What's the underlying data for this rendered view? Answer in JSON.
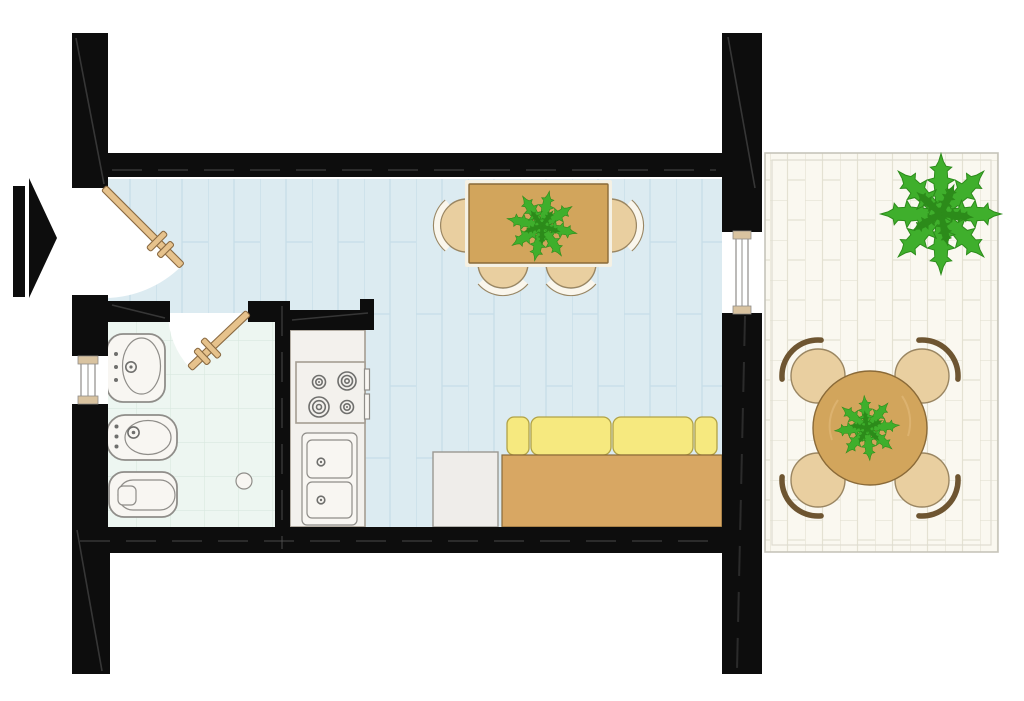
{
  "document": {
    "kind": "floor-plan"
  },
  "colors": {
    "wall": "#0d0d0d",
    "hatch": "#5a5a5a",
    "paper": "#ffffff",
    "livingFloor": "#dcebf1",
    "livingLine": "#c6dde8",
    "bathFloor": "#edf6f1",
    "bathLine": "#d8e8df",
    "terraceFloor": "#faf8f0",
    "terraceLine": "#e4e1d2",
    "terraceBorder": "#c6c4ba",
    "terraceBorderInner": "#dedcd0",
    "wood": "#d2a55c",
    "woodEdge": "#8a6a38",
    "woodLight": "#e0b877",
    "tableFrame": "#f5f1e4",
    "door": "#e6c28c",
    "doorEdge": "#8a6a42",
    "chairSeat": "#e9cfa0",
    "chairSeatEdge": "#9a8662",
    "chairBand": "#faf6ec",
    "chairBackDark": "#6e5531",
    "sofaBase": "#d8a763",
    "sofaCushion": "#f6e97f",
    "sofaCushionEdge": "#b1a246",
    "sideTable": "#efedea",
    "sideTableEdge": "#9a9892",
    "fixture": "#f8f6f2",
    "fixtureEdge": "#8f8d89",
    "counter": "#f3f1ed",
    "counterEdge": "#a59d92",
    "burnerEdge": "#6f6f6d",
    "windowCap": "#d9c3a0",
    "plant": "#3faf2c",
    "plantDark": "#2c8b1a"
  },
  "plan": {
    "rooms": [
      {
        "name": "living-room",
        "floor": "light-blue-planks",
        "furniture": [
          "dining-table",
          "dining-chairs",
          "plant",
          "sofa",
          "side-table"
        ]
      },
      {
        "name": "bathroom",
        "floor": "mint-tile-grid",
        "fixtures": [
          "sink",
          "bidet",
          "toilet",
          "floor-drain"
        ]
      },
      {
        "name": "kitchen",
        "fixtures": [
          "stove-4-burners",
          "double-sink-cabinet"
        ]
      },
      {
        "name": "terrace",
        "floor": "cream-brick-tiles",
        "furniture": [
          "round-table",
          "terrace-chairs",
          "plant"
        ]
      }
    ],
    "symbols": [
      "entrance-arrow",
      "entrance-door-swing",
      "bathroom-door-swing",
      "window-left",
      "window-right"
    ],
    "counts": {
      "dining_chairs": 4,
      "terrace_chairs": 4,
      "stove_burners": 4,
      "sofa_cushions": 4,
      "plants": 3,
      "windows": 2,
      "doors": 2
    }
  }
}
